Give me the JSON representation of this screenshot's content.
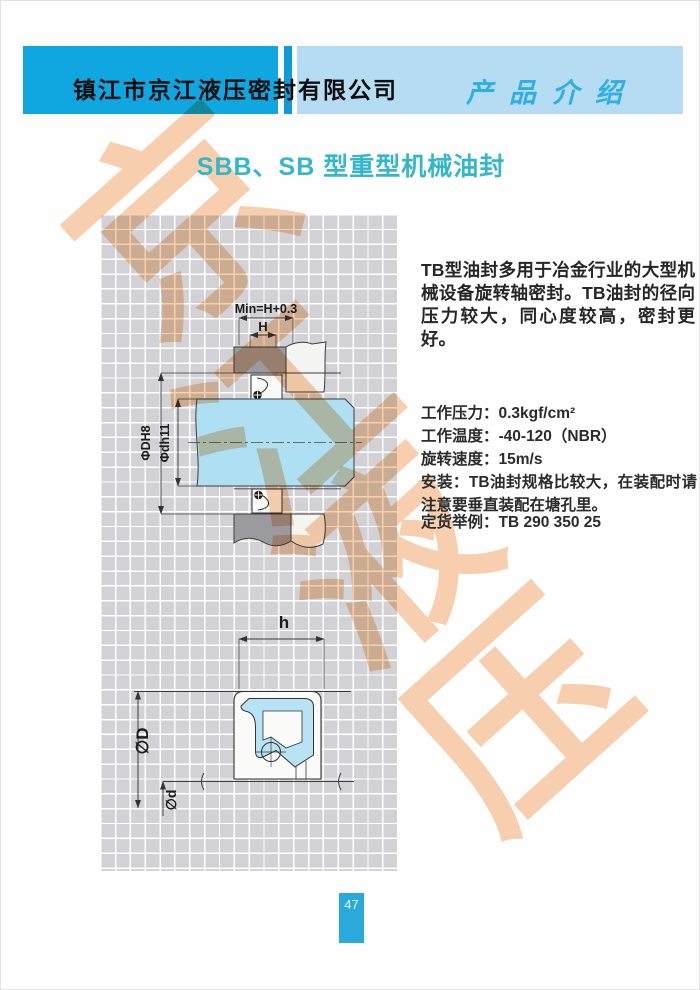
{
  "header": {
    "company": "镇江市京江液压密封有限公司",
    "section": "产品介绍",
    "band_dark_color": "#10a6e0",
    "band_light_color": "#b5dcf3"
  },
  "title": "SBB、SB 型重型机械油封",
  "title_color": "#35b6c9",
  "intro": "TB型油封多用于冶金行业的大型机械设备旋转轴密封。TB油封的径向压力较大，同心度较高，密封更好。",
  "specs": [
    "工作压力：0.3kgf/cm²",
    "工作温度：-40-120（NBR）",
    "旋转速度：15m/s"
  ],
  "install_note": "安装：TB油封规格比较大，在装配时请注意要垂直装配在塘孔里。",
  "order_example": "定货举例：TB 290 350 25",
  "drawing": {
    "shaft_color": "#aedff2",
    "housing_gray": "#9b9b9f",
    "labels": {
      "min": "Min=H+0.3",
      "H": "H",
      "phiDH8": "ΦDH8",
      "phidh11": "Φdh11",
      "h": "h",
      "phiD": "∅D",
      "phid": "∅d"
    }
  },
  "watermark": {
    "chars": [
      "京",
      "江",
      "液",
      "压"
    ],
    "color": "#f0a25f"
  },
  "page_number": "47"
}
